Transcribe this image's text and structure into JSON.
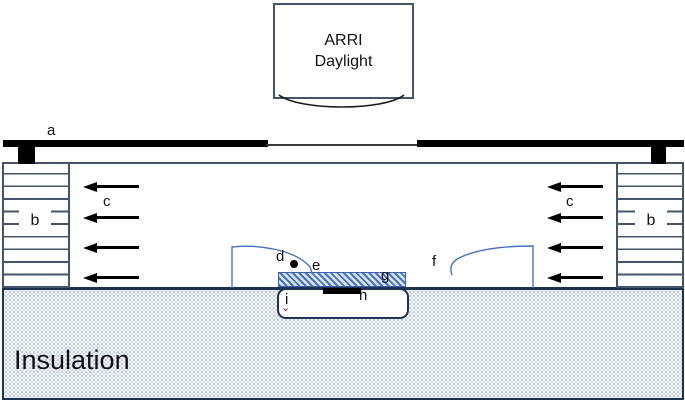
{
  "lamp": {
    "line1": "ARRI",
    "line2": "Daylight"
  },
  "annotations": {
    "a": "a",
    "b_left": "b",
    "b_right": "b",
    "c_left": "c",
    "c_right": "c",
    "d": "d",
    "e": "e",
    "f": "f",
    "g": "g",
    "h": "h",
    "i": "i"
  },
  "insulation_label": "Insulation",
  "marker": {
    "red_caret": "⌄"
  },
  "colors": {
    "outline_navy": "#44546A",
    "cavity_border_navy": "#1f3254",
    "streamline_blue": "#4472C4",
    "hatch_blue": "#4472C4",
    "hatch_background": "#dbe5f3",
    "insulation_dot": "#a9bedf",
    "marker_red": "#C00000",
    "bar_black": "#000000"
  }
}
